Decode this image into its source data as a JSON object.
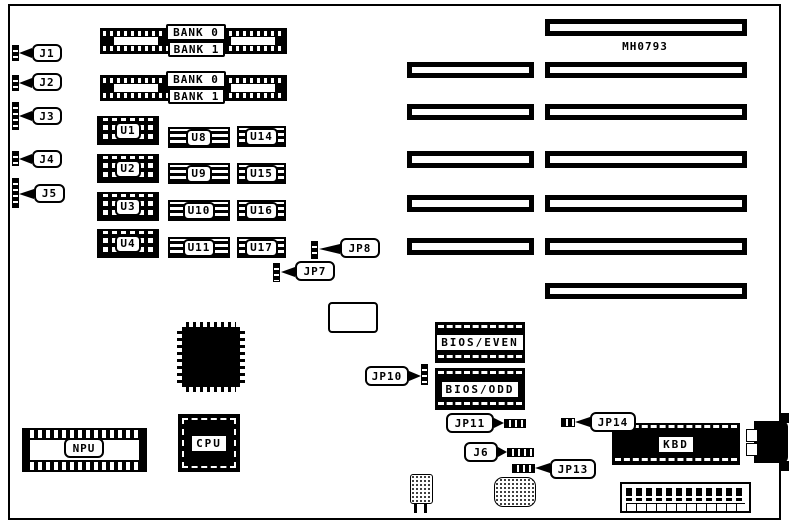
{
  "board": {
    "part_number": "MH0793",
    "background": "#ffffff",
    "line_color": "#000000"
  },
  "left_connectors": [
    {
      "label": "J1"
    },
    {
      "label": "J2"
    },
    {
      "label": "J3"
    },
    {
      "label": "J4"
    },
    {
      "label": "J5"
    }
  ],
  "memory_banks": {
    "groups": [
      {
        "rows": [
          "BANK 0",
          "BANK 1"
        ]
      },
      {
        "rows": [
          "BANK 0",
          "BANK 1"
        ]
      }
    ]
  },
  "ram_chips": {
    "col1": [
      "U1",
      "U2",
      "U3",
      "U4"
    ],
    "col2": [
      "U8",
      "U9",
      "U10",
      "U11"
    ],
    "col3": [
      "U14",
      "U15",
      "U16",
      "U17"
    ]
  },
  "jumpers": {
    "jp7": "JP7",
    "jp8": "JP8",
    "jp10": "JP10",
    "jp11": "JP11",
    "j6": "J6",
    "jp13": "JP13",
    "jp14": "JP14"
  },
  "chips": {
    "bios_even": "BIOS/EVEN",
    "bios_odd": "BIOS/ODD",
    "npu": "NPU",
    "cpu": "CPU",
    "kbd": "KBD"
  },
  "expansion_slots": {
    "count": 13,
    "rows_with_pairs": 5,
    "single_long_rows": 2
  }
}
